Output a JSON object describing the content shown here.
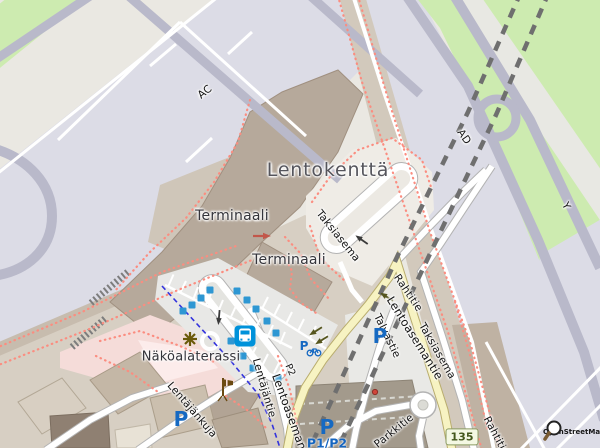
{
  "map": {
    "attribution": "OpenStreetMap",
    "route_shield": "135",
    "area_labels": {
      "lentokentta": "Lentokenttä",
      "terminaali_1": "Terminaali",
      "terminaali_2": "Terminaali",
      "nakoalaterassi": "Näköalaterassi"
    },
    "street_labels": {
      "ac": "AC",
      "ad": "AD",
      "y": "Y",
      "taksiasema_1": "Taksiasema",
      "taksiasema_2": "Taksiasema",
      "rahtitie_1": "Rahtitie",
      "rahtitie_2": "Rahtitie",
      "lentoasemantie_1": "Lentoasemantie",
      "lentoasemantie_2": "Lentoasemantie",
      "lentajantie": "Lentäjäntie",
      "lentajankuja": "Lentäjänkuja",
      "talvastie": "Talvastie",
      "parkkitie": "Parkkitie",
      "p2": "P2"
    },
    "parking": {
      "symbol": "P",
      "p1p2": "P1/P2"
    },
    "colors": {
      "grass": "#cdebb0",
      "apron": "#dcdce6",
      "taxiway": "#b9b9ca",
      "building": "#b6a99b",
      "secondary_road": "#f7f3c2",
      "footway_dots": "#fb8d80",
      "cycleway": "#3333dd",
      "tunnel_dash": "#6f6f6f",
      "parking_blue": "#1669c2",
      "transit_blue": "#0092da",
      "shield_bg": "#f4f8e3",
      "shield_text": "#44571c"
    },
    "icons": [
      "bus-station-icon",
      "bus-stop-marker",
      "parking-icon",
      "bicycle-parking-icon",
      "viewpoint-icon",
      "windsock-icon",
      "osm-logo-icon"
    ]
  }
}
